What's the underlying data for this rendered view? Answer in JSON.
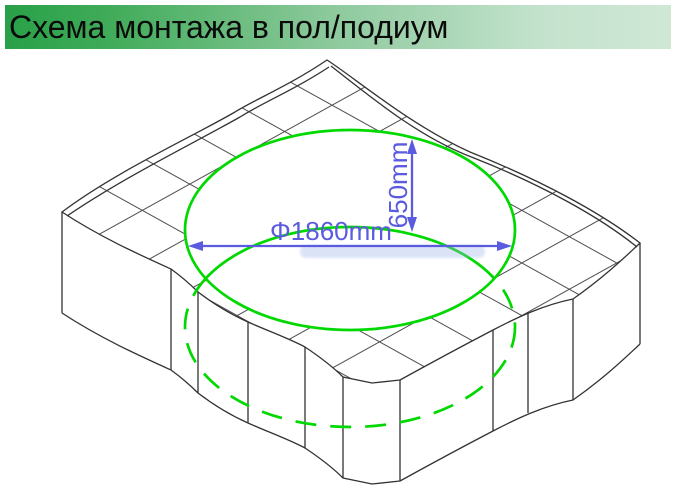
{
  "title": {
    "text": "Схема монтажа в пол/подиум"
  },
  "diagram": {
    "labels": {
      "diameter": "Φ1860mm",
      "depth": "650mm"
    },
    "colors": {
      "title_green": "#28a048",
      "tub_green": "#00d800",
      "dimension_blue": "#5b5be0",
      "outline_black": "#333333",
      "hatch_gray": "#4d4d4d"
    }
  }
}
